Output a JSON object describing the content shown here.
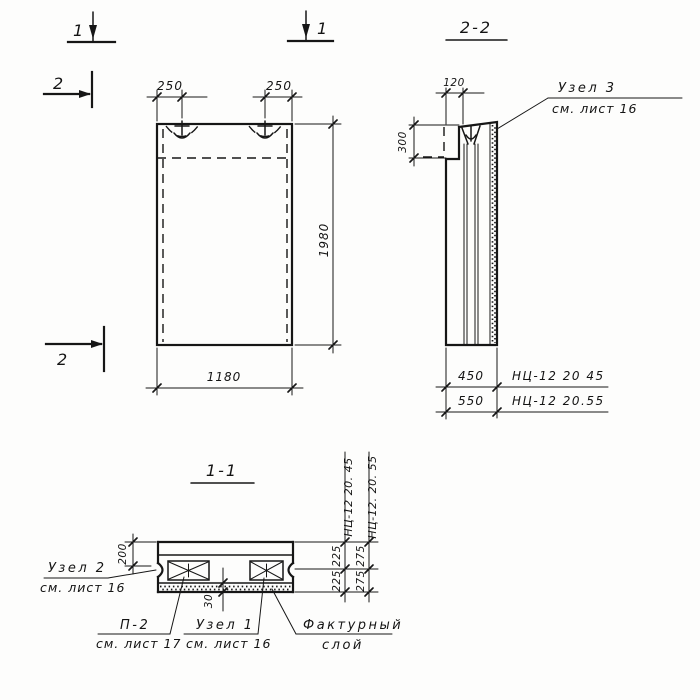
{
  "markers": {
    "sec1_left": "1",
    "sec1_right": "1",
    "sec2_top": "2",
    "sec2_bottom": "2"
  },
  "front_view": {
    "dim_loop_left": "250",
    "dim_loop_right": "250",
    "dim_height": "1980",
    "dim_width": "1180"
  },
  "section_2_2": {
    "title": "2-2",
    "dim_top_offset": "120",
    "dim_step_height": "300",
    "node3": {
      "label": "Узел 3",
      "ref": "см. лист 16"
    },
    "variants": [
      {
        "thickness": "450",
        "mark": "НЦ-12 20 45"
      },
      {
        "thickness": "550",
        "mark": "НЦ-12 20.55"
      }
    ]
  },
  "section_1_1": {
    "title": "1-1",
    "dim_rib": "200",
    "dim_layer": "30",
    "columns": [
      {
        "mark": "НЦ-12 20. 45",
        "top": "225",
        "bottom": "225"
      },
      {
        "mark": "НЦ-12. 20. 55",
        "top": "275",
        "bottom": "275"
      }
    ],
    "node2": {
      "label": "Узел 2",
      "ref": "см. лист 16"
    },
    "p2": {
      "label": "П-2",
      "ref": "см. лист 17"
    },
    "node1": {
      "label": "Узел 1",
      "ref": "см. лист 16"
    },
    "facture": {
      "line1": "Фактурный",
      "line2": "слой"
    }
  }
}
